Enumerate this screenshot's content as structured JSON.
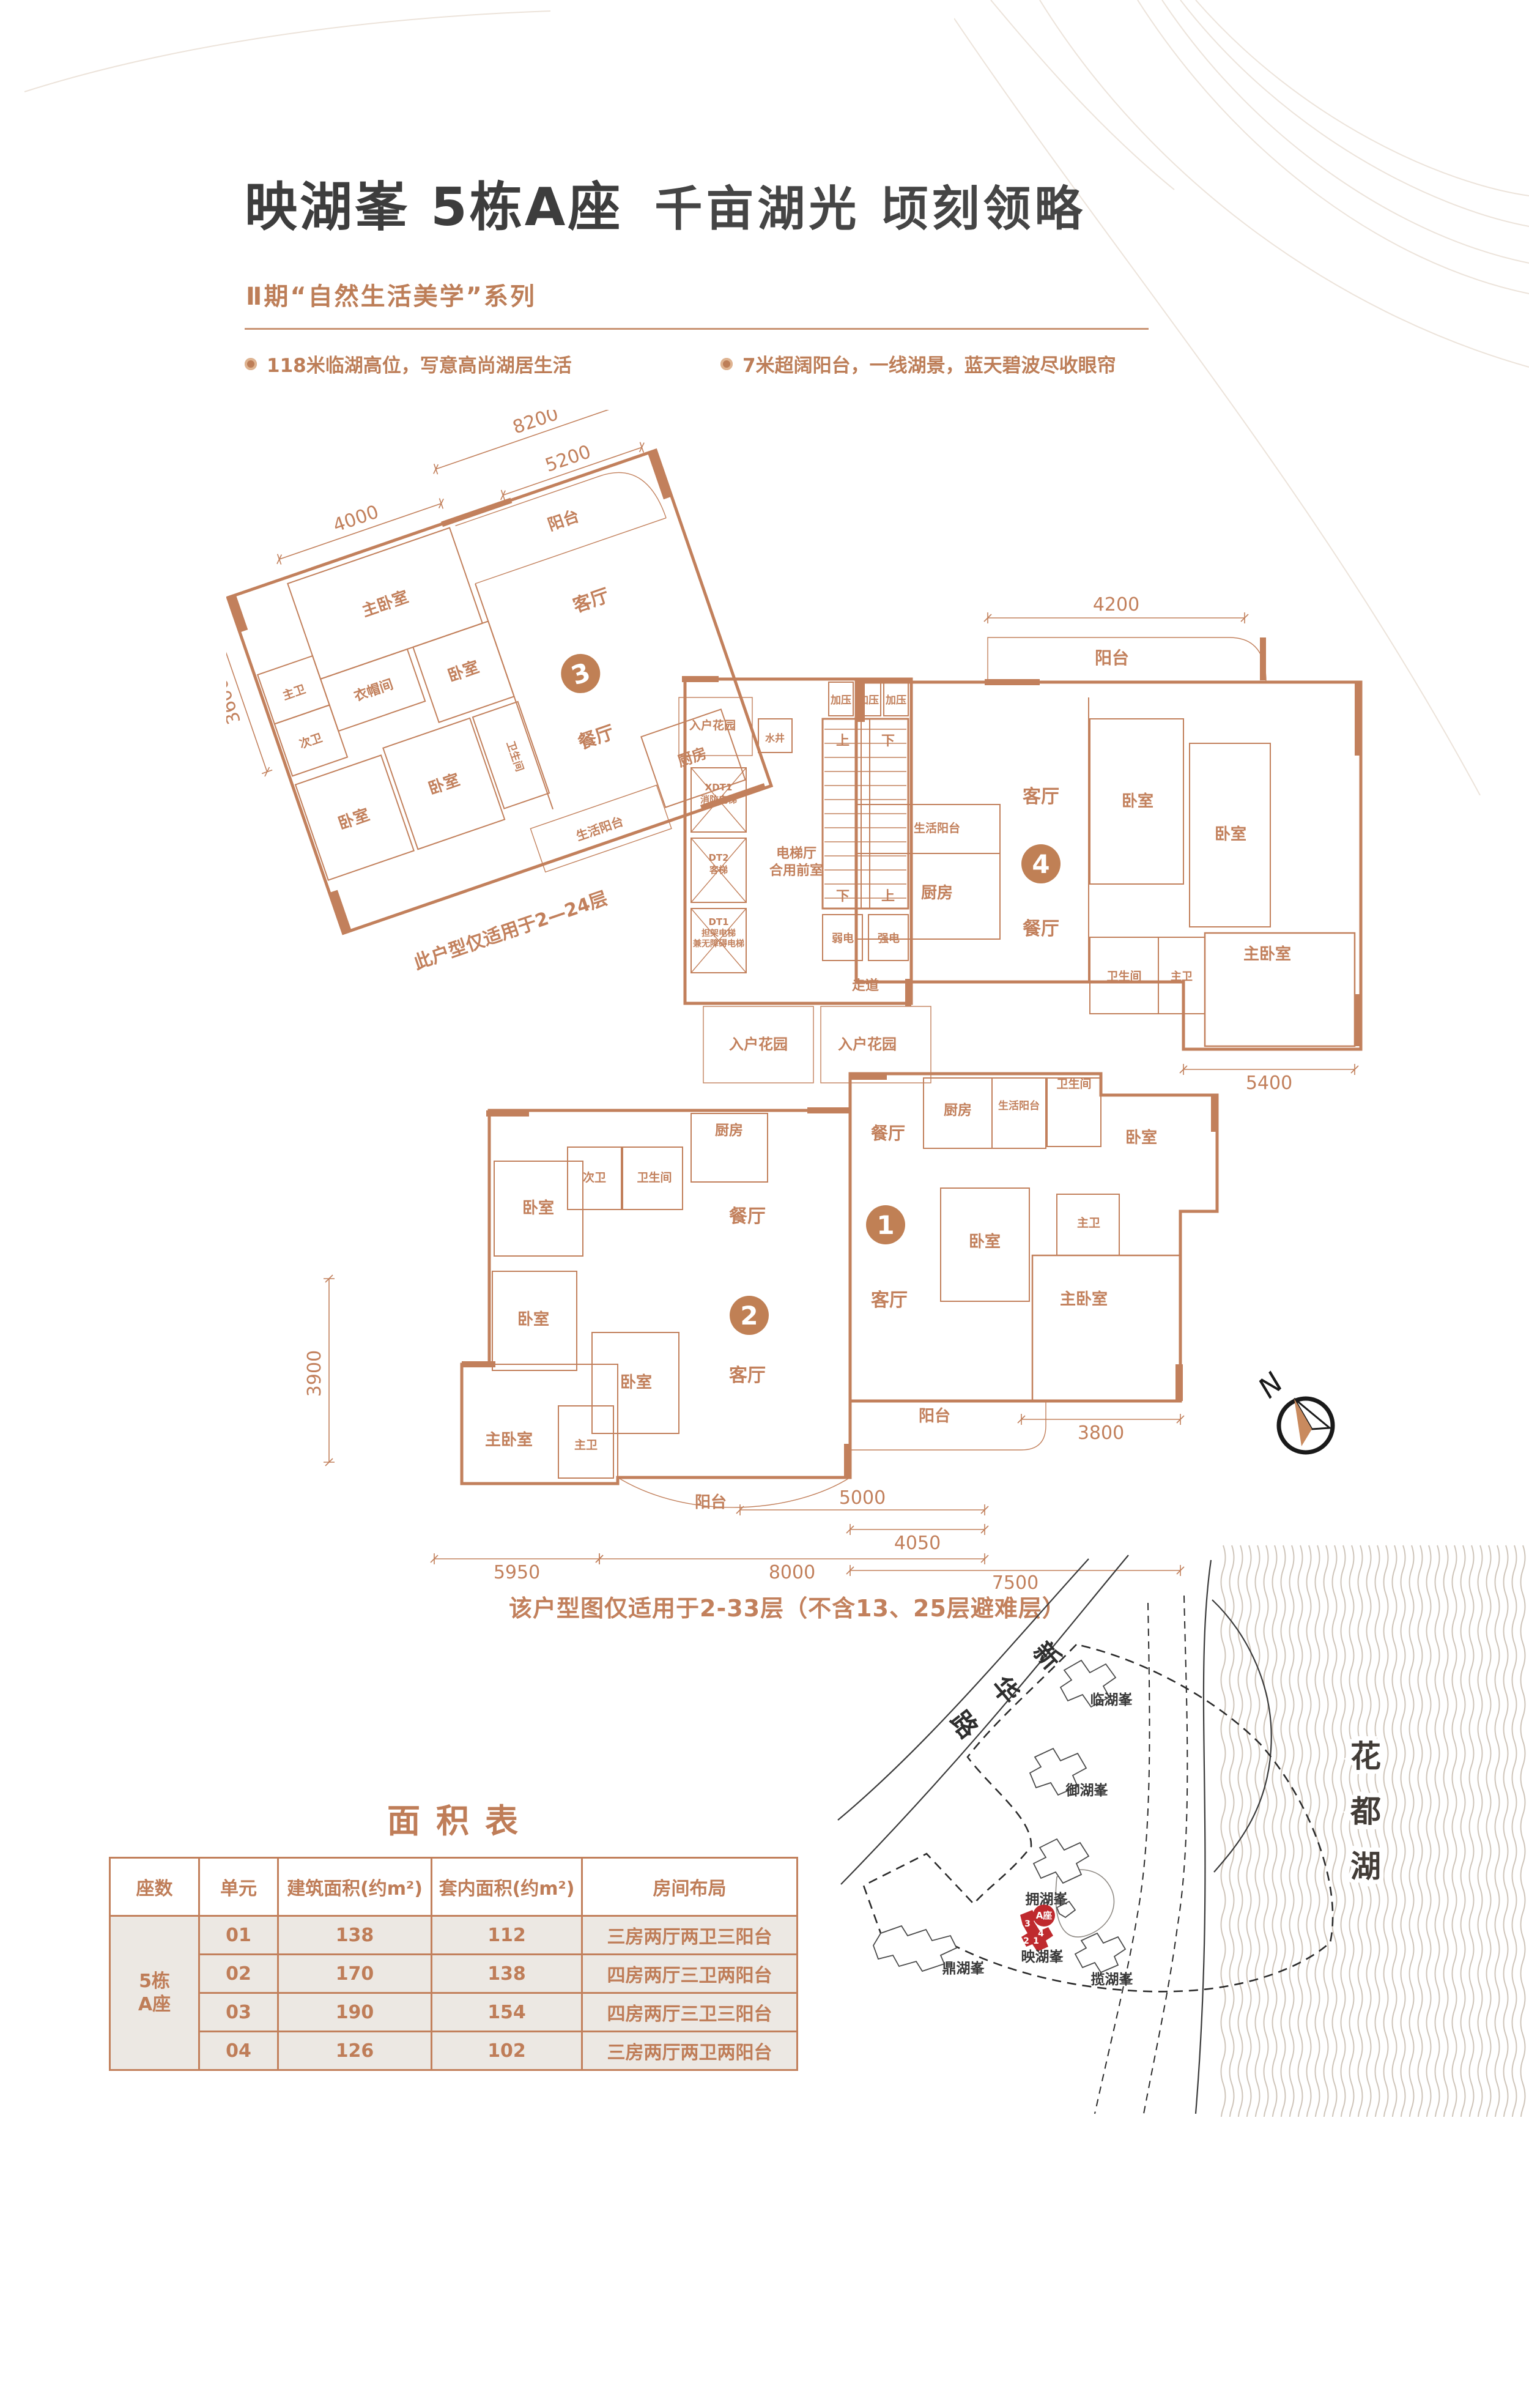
{
  "header": {
    "title_bold": "映湖峯 5栋A座",
    "title_light": "千亩湖光 顷刻领略",
    "series": "Ⅱ期“自然生活美学”系列",
    "bullets": [
      "118米临湖高位，写意高尚湖居生活",
      "7米超阔阳台，一线湖景，蓝天碧波尽收眼帘"
    ]
  },
  "floorplan": {
    "bottom_note": "该户型图仅适用于2-33层（不含13、25层避难层）",
    "compass_n": "N",
    "u3": {
      "note": {
        "t": "此户型仅适用于2—24层",
        "x": 340,
        "y": 805,
        "s": 30
      },
      "circle": {
        "t": "3",
        "x": 585,
        "y": 435
      },
      "labels": [
        {
          "t": "主卧室",
          "x": 320,
          "y": 232,
          "s": 26
        },
        {
          "t": "阳台",
          "x": 640,
          "y": 198,
          "s": 26
        },
        {
          "t": "衣帽间",
          "x": 256,
          "y": 358,
          "s": 22
        },
        {
          "t": "主卫",
          "x": 132,
          "y": 318,
          "s": 19
        },
        {
          "t": "次卫",
          "x": 132,
          "y": 402,
          "s": 19
        },
        {
          "t": "卧室",
          "x": 405,
          "y": 378,
          "s": 26
        },
        {
          "t": "客厅",
          "x": 640,
          "y": 338,
          "s": 30
        },
        {
          "t": "餐厅",
          "x": 575,
          "y": 552,
          "s": 30
        },
        {
          "t": "卧室",
          "x": 157,
          "y": 548,
          "s": 26
        },
        {
          "t": "卧室",
          "x": 315,
          "y": 542,
          "s": 26
        },
        {
          "t": "卫生间",
          "x": 434,
          "y": 528,
          "s": 17,
          "r": 90
        },
        {
          "t": "厨房",
          "x": 713,
          "y": 632,
          "s": 24
        },
        {
          "t": "生活阳台",
          "x": 532,
          "y": 692,
          "s": 20
        }
      ],
      "dims": [
        {
          "t": "3600",
          "x1": 48,
          "y1": 150,
          "x2": 48,
          "y2": 420,
          "lx": 34,
          "ly": 290,
          "v": 1
        },
        {
          "t": "4000",
          "x1": 180,
          "y1": 98,
          "x2": 460,
          "y2": 98,
          "lx": 320,
          "ly": 86
        },
        {
          "t": "8200",
          "x1": 470,
          "y1": 42,
          "x2": 830,
          "y2": 42,
          "lx": 650,
          "ly": 30
        },
        {
          "t": "5200",
          "x1": 560,
          "y1": 118,
          "x2": 800,
          "y2": 118,
          "lx": 680,
          "ly": 106
        }
      ]
    },
    "circles": [
      {
        "t": "4",
        "x": 1332,
        "y": 742
      },
      {
        "t": "1",
        "x": 1078,
        "y": 1332
      },
      {
        "t": "2",
        "x": 855,
        "y": 1480
      }
    ],
    "labels": [
      {
        "t": "加压",
        "x": 1005,
        "y": 480,
        "s": 17
      },
      {
        "t": "加压",
        "x": 1050,
        "y": 480,
        "s": 17
      },
      {
        "t": "加压",
        "x": 1095,
        "y": 480,
        "s": 17
      },
      {
        "t": "上",
        "x": 1008,
        "y": 548,
        "s": 22
      },
      {
        "t": "下",
        "x": 1082,
        "y": 548,
        "s": 22
      },
      {
        "t": "下",
        "x": 1008,
        "y": 802,
        "s": 22
      },
      {
        "t": "上",
        "x": 1082,
        "y": 802,
        "s": 22
      },
      {
        "t": "水井",
        "x": 897,
        "y": 542,
        "s": 16
      },
      {
        "t": "XDT1",
        "x": 805,
        "y": 622,
        "s": 15
      },
      {
        "t": "消防电梯",
        "x": 805,
        "y": 642,
        "s": 15
      },
      {
        "t": "DT2",
        "x": 805,
        "y": 737,
        "s": 15
      },
      {
        "t": "客梯",
        "x": 805,
        "y": 757,
        "s": 15
      },
      {
        "t": "DT1",
        "x": 805,
        "y": 842,
        "s": 15
      },
      {
        "t": "担架电梯",
        "x": 805,
        "y": 860,
        "s": 14
      },
      {
        "t": "兼无障碍电梯",
        "x": 805,
        "y": 877,
        "s": 14
      },
      {
        "t": "电梯厅",
        "x": 932,
        "y": 732,
        "s": 22
      },
      {
        "t": "合用前室",
        "x": 932,
        "y": 760,
        "s": 22
      },
      {
        "t": "弱电",
        "x": 1008,
        "y": 870,
        "s": 18
      },
      {
        "t": "强电",
        "x": 1083,
        "y": 870,
        "s": 18
      },
      {
        "t": "走道",
        "x": 1045,
        "y": 948,
        "s": 22
      },
      {
        "t": "入户花园",
        "x": 795,
        "y": 522,
        "s": 19
      },
      {
        "t": "入户花园",
        "x": 870,
        "y": 1045,
        "s": 24
      },
      {
        "t": "入户花园",
        "x": 1048,
        "y": 1045,
        "s": 24
      },
      {
        "t": "阳台",
        "x": 1448,
        "y": 415,
        "s": 28
      },
      {
        "t": "客厅",
        "x": 1332,
        "y": 642,
        "s": 30
      },
      {
        "t": "餐厅",
        "x": 1332,
        "y": 858,
        "s": 30
      },
      {
        "t": "生活阳台",
        "x": 1162,
        "y": 690,
        "s": 19
      },
      {
        "t": "厨房",
        "x": 1162,
        "y": 798,
        "s": 26
      },
      {
        "t": "卧室",
        "x": 1490,
        "y": 648,
        "s": 26
      },
      {
        "t": "卧室",
        "x": 1642,
        "y": 702,
        "s": 26
      },
      {
        "t": "卫生间",
        "x": 1468,
        "y": 932,
        "s": 19
      },
      {
        "t": "主卫",
        "x": 1562,
        "y": 932,
        "s": 18
      },
      {
        "t": "主卧室",
        "x": 1702,
        "y": 898,
        "s": 26
      },
      {
        "t": "餐厅",
        "x": 1082,
        "y": 1192,
        "s": 28
      },
      {
        "t": "厨房",
        "x": 1196,
        "y": 1152,
        "s": 23
      },
      {
        "t": "生活阳台",
        "x": 1296,
        "y": 1143,
        "s": 17
      },
      {
        "t": "卫生间",
        "x": 1386,
        "y": 1108,
        "s": 19
      },
      {
        "t": "卧室",
        "x": 1496,
        "y": 1198,
        "s": 26
      },
      {
        "t": "卧室",
        "x": 1240,
        "y": 1368,
        "s": 26
      },
      {
        "t": "主卫",
        "x": 1410,
        "y": 1335,
        "s": 19
      },
      {
        "t": "主卧室",
        "x": 1402,
        "y": 1462,
        "s": 26
      },
      {
        "t": "客厅",
        "x": 1084,
        "y": 1465,
        "s": 30
      },
      {
        "t": "阳台",
        "x": 1158,
        "y": 1653,
        "s": 26
      },
      {
        "t": "厨房",
        "x": 822,
        "y": 1185,
        "s": 23
      },
      {
        "t": "次卫",
        "x": 602,
        "y": 1261,
        "s": 19
      },
      {
        "t": "卫生间",
        "x": 700,
        "y": 1261,
        "s": 19
      },
      {
        "t": "卧室",
        "x": 510,
        "y": 1313,
        "s": 26
      },
      {
        "t": "餐厅",
        "x": 852,
        "y": 1328,
        "s": 30
      },
      {
        "t": "卧室",
        "x": 502,
        "y": 1495,
        "s": 26
      },
      {
        "t": "卧室",
        "x": 670,
        "y": 1598,
        "s": 26
      },
      {
        "t": "主卧室",
        "x": 462,
        "y": 1692,
        "s": 26
      },
      {
        "t": "主卫",
        "x": 588,
        "y": 1698,
        "s": 19
      },
      {
        "t": "客厅",
        "x": 852,
        "y": 1588,
        "s": 30
      },
      {
        "t": "阳台",
        "x": 792,
        "y": 1794,
        "s": 26
      }
    ],
    "dims": [
      {
        "t": "4200",
        "x1": 1245,
        "y1": 340,
        "x2": 1665,
        "y2": 340,
        "lx": 1455,
        "ly": 328
      },
      {
        "t": "5400",
        "x1": 1565,
        "y1": 1078,
        "x2": 1845,
        "y2": 1078,
        "lx": 1705,
        "ly": 1110
      },
      {
        "t": "3800",
        "x1": 1300,
        "y1": 1650,
        "x2": 1560,
        "y2": 1650,
        "lx": 1430,
        "ly": 1682
      },
      {
        "t": "4050",
        "x1": 1020,
        "y1": 1830,
        "x2": 1240,
        "y2": 1830,
        "lx": 1130,
        "ly": 1862
      },
      {
        "t": "7500",
        "x1": 1020,
        "y1": 1897,
        "x2": 1560,
        "y2": 1897,
        "lx": 1290,
        "ly": 1927
      },
      {
        "t": "5000",
        "x1": 840,
        "y1": 1798,
        "x2": 1240,
        "y2": 1798,
        "lx": 1040,
        "ly": 1788
      },
      {
        "t": "5950",
        "x1": 340,
        "y1": 1878,
        "x2": 610,
        "y2": 1878,
        "lx": 475,
        "ly": 1910
      },
      {
        "t": "8000",
        "x1": 610,
        "y1": 1878,
        "x2": 1240,
        "y2": 1878,
        "lx": 925,
        "ly": 1910
      },
      {
        "t": "3900",
        "x1": 168,
        "y1": 1420,
        "x2": 168,
        "y2": 1720,
        "lx": 154,
        "ly": 1575,
        "v": 1
      }
    ]
  },
  "area_table": {
    "title": "面积表",
    "headers": [
      "座数",
      "单元",
      "建筑面积(约m²)",
      "套内面积(约m²)",
      "房间布局"
    ],
    "building": "5栋\nA座",
    "rows": [
      {
        "unit": "01",
        "gross": "138",
        "inner": "112",
        "layout": "三房两厅两卫三阳台"
      },
      {
        "unit": "02",
        "gross": "170",
        "inner": "138",
        "layout": "四房两厅三卫两阳台"
      },
      {
        "unit": "03",
        "gross": "190",
        "inner": "154",
        "layout": "四房两厅三卫三阳台"
      },
      {
        "unit": "04",
        "gross": "126",
        "inner": "102",
        "layout": "三房两厅两卫两阳台"
      }
    ]
  },
  "sitemap": {
    "road_chars": [
      {
        "t": "新",
        "x": 361,
        "y": 196,
        "r": 48
      },
      {
        "t": "华",
        "x": 293,
        "y": 252,
        "r": 50
      },
      {
        "t": "路",
        "x": 225,
        "y": 308,
        "r": 52
      }
    ],
    "estates": [
      {
        "t": "临湖峯",
        "x": 477,
        "y": 266
      },
      {
        "t": "御湖峯",
        "x": 437,
        "y": 414
      },
      {
        "t": "拥湖峯",
        "x": 371,
        "y": 592
      },
      {
        "t": "映湖峯",
        "x": 364,
        "y": 686
      },
      {
        "t": "鼎湖峯",
        "x": 235,
        "y": 705
      },
      {
        "t": "揽湖峯",
        "x": 478,
        "y": 723
      }
    ],
    "lake_chars": [
      {
        "t": "花",
        "x": 893,
        "y": 368
      },
      {
        "t": "都",
        "x": 893,
        "y": 458
      },
      {
        "t": "湖",
        "x": 893,
        "y": 548
      }
    ],
    "badge": {
      "t": "A座",
      "x": 367,
      "y": 611
    },
    "unit_nums": [
      {
        "t": "3",
        "x": 340,
        "y": 629
      },
      {
        "t": "4",
        "x": 362,
        "y": 645
      },
      {
        "t": "2",
        "x": 338,
        "y": 657
      },
      {
        "t": "1",
        "x": 354,
        "y": 657
      }
    ]
  }
}
